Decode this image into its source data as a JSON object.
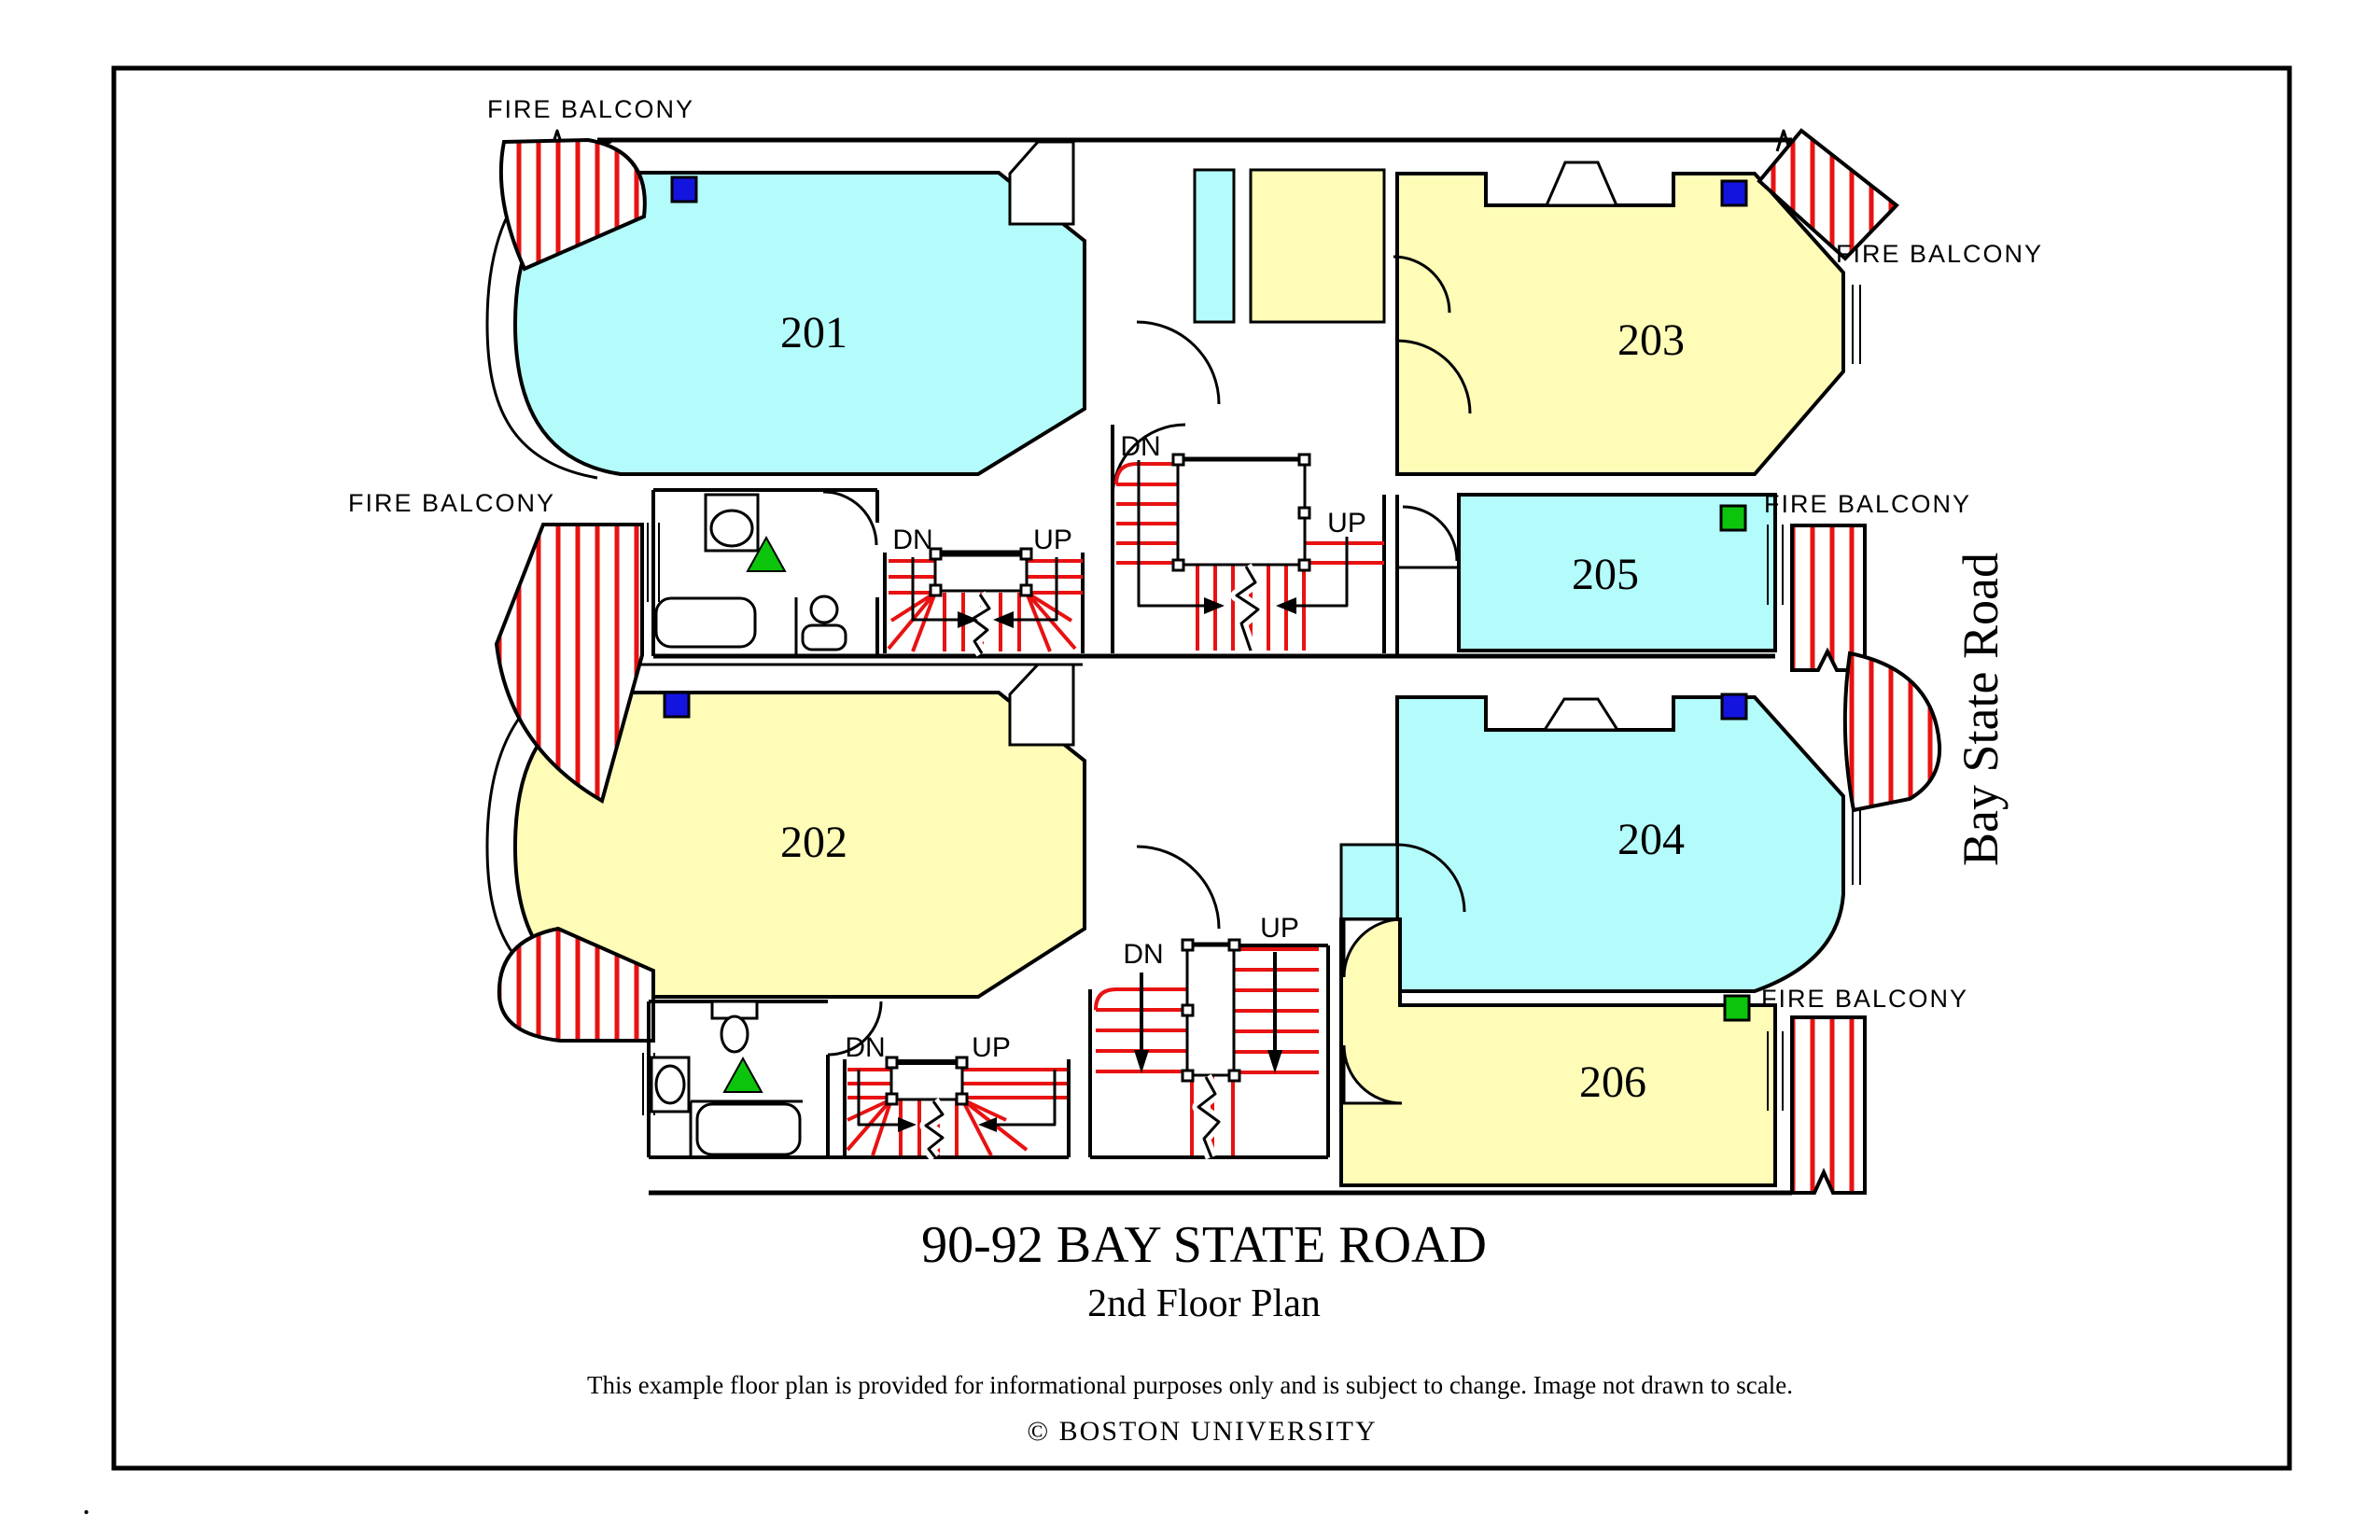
{
  "labels": {
    "fire_balcony": "FIRE BALCONY",
    "dn": "DN",
    "up": "UP"
  },
  "rooms": [
    {
      "number": "201"
    },
    {
      "number": "202"
    },
    {
      "number": "203"
    },
    {
      "number": "204"
    },
    {
      "number": "205"
    },
    {
      "number": "206"
    }
  ],
  "footer": {
    "title": "90-92 BAY STATE ROAD",
    "subtitle": "2nd Floor Plan",
    "disclaimer": "This example floor plan is provided for informational purposes only and is subject to change. Image not drawn to scale.",
    "copyright": "© BOSTON UNIVERSITY"
  },
  "street": {
    "name": "Bay State Road"
  },
  "corner_mark": ".",
  "colors": {
    "room_cyan": "#B4FBFB",
    "room_yellow": "#FFFCB8",
    "marker_blue": "#1414DF",
    "marker_green": "#0CC40C",
    "stripe_red": "#E81212",
    "wall": "#000000"
  }
}
